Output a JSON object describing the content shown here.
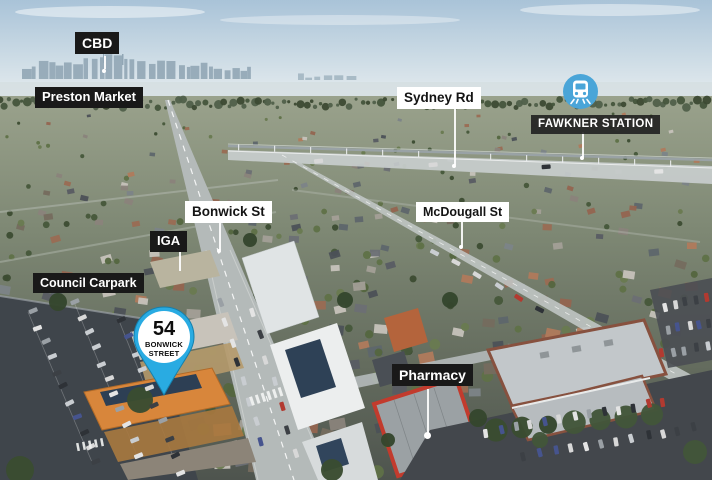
{
  "labels": {
    "cbd": "CBD",
    "preston_market": "Preston Market",
    "sydney_rd": "Sydney Rd",
    "fawkner_station": "FAWKNER STATION",
    "bonwick_st": "Bonwick St",
    "mcdougall_st": "McDougall St",
    "iga": "IGA",
    "council_carpark": "Council Carpark",
    "pharmacy": "Pharmacy"
  },
  "pin": {
    "number": "54",
    "street": "BONWICK STREET"
  },
  "icons": {
    "station": "train-icon",
    "property": "map-pin-icon"
  },
  "colors": {
    "pin_blue": "#29ABE2",
    "station_circle_blue": "#4AA5D8",
    "dark_label_bg": "#191919",
    "light_label_bg": "#FFFFFF",
    "subject_roof_orange": "#D8863B",
    "pharmacy_red": "#C23B2D"
  }
}
